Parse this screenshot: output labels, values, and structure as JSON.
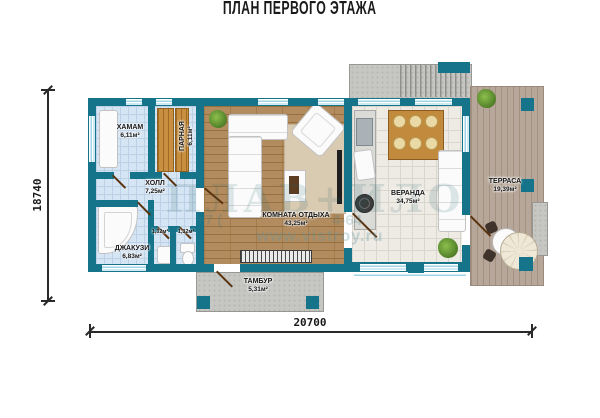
{
  "title": "ПЛАН ПЕРВОГО ЭТАЖА",
  "dimensions": {
    "height": "18740",
    "width": "20700"
  },
  "rooms": {
    "hamam": {
      "name": "ХАМАМ",
      "area": "6,11м²"
    },
    "parnaya": {
      "name": "ПАРНАЯ",
      "area": "6,11м²"
    },
    "hall": {
      "name": "ХОЛЛ",
      "area": "7,25м²"
    },
    "jacuzzi": {
      "name": "ДЖАКУЗИ",
      "area": "6,83м²"
    },
    "wc_left": {
      "area": "1,32м²"
    },
    "wc_right": {
      "area": "1,32м²"
    },
    "lounge": {
      "name": "КОМНАТА ОТДЫХА",
      "area": "43,25м²"
    },
    "veranda": {
      "name": "ВЕРАНДА",
      "area": "34,75м²"
    },
    "terrace": {
      "name": "ТЕРРАСА",
      "area": "19,39м²"
    },
    "tambour": {
      "name": "ТАМБУР",
      "area": "5,31м²"
    }
  },
  "watermark": {
    "logo": "ПЛАВ+ИЛО",
    "phone_left": "+7 (",
    "phone_right": "4-64",
    "url": "www.vistroy.ru"
  },
  "colors": {
    "wall": "#16748a",
    "wood_floor": "#b28c5f",
    "tile_blue": "#d6e5f3",
    "tile_light": "#edebe4",
    "deck": "#b7a79a",
    "concrete": "#c6c6c3",
    "bench_wood": "#c78f3f"
  }
}
